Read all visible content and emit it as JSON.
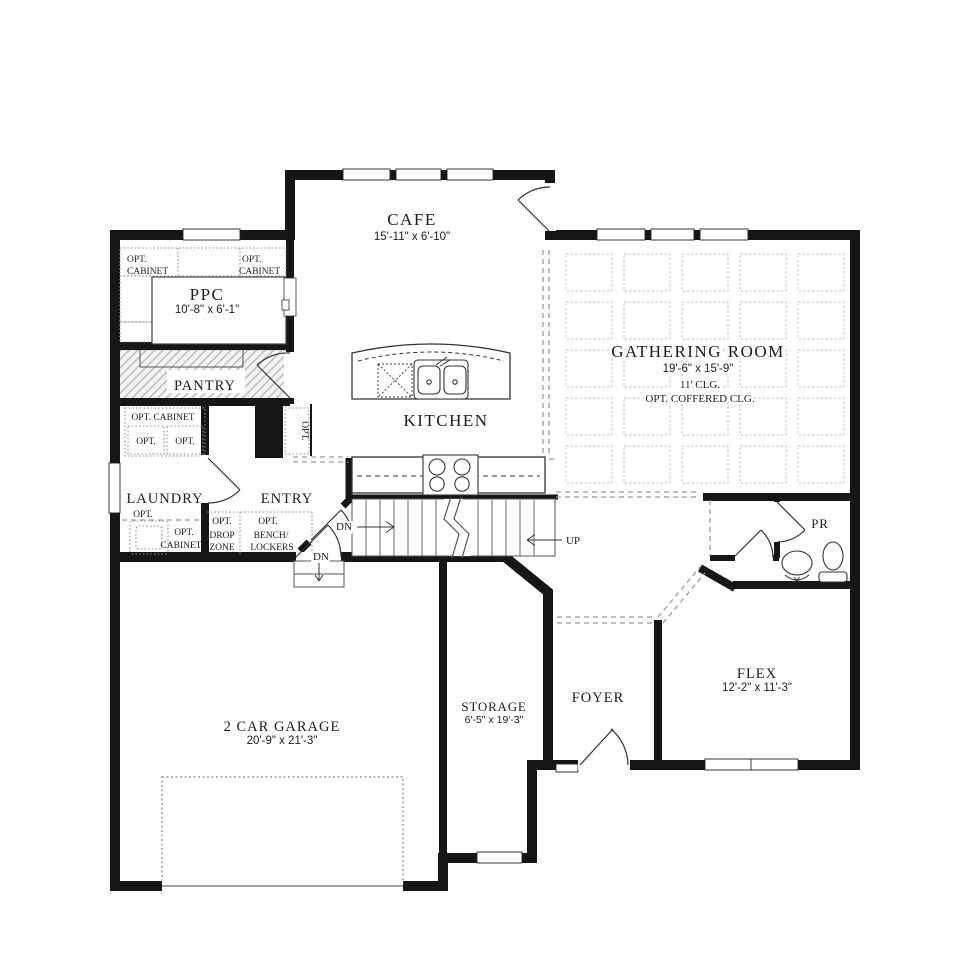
{
  "rooms": {
    "cafe": {
      "label": "CAFE",
      "dims": "15'-11\" x 6'-10\""
    },
    "ppc": {
      "label": "PPC",
      "dims": "10'-8\" x 6'-1\""
    },
    "pantry": {
      "label": "PANTRY"
    },
    "laundry": {
      "label": "LAUNDRY"
    },
    "entry": {
      "label": "ENTRY"
    },
    "kitchen": {
      "label": "KITCHEN"
    },
    "gathering_room": {
      "label": "GATHERING ROOM",
      "dims": "19'-6\" x 15'-9\"",
      "ceiling": "11' CLG.",
      "ceiling_option": "OPT. COFFERED CLG."
    },
    "powder_room": {
      "label": "PR"
    },
    "flex": {
      "label": "FLEX",
      "dims": "12'-2\" x 11'-3\""
    },
    "foyer": {
      "label": "FOYER"
    },
    "storage": {
      "label": "STORAGE",
      "dims": "6'-5\" x 19'-3\""
    },
    "garage": {
      "label": "2 CAR GARAGE",
      "dims": "20'-9\" x 21'-3\""
    }
  },
  "options": {
    "opt": "OPT.",
    "cabinet": "CABINET",
    "opt_cabinet_line": "OPT. CABINET",
    "drop_zone_l1": "OPT.",
    "drop_zone_l2": "DROP",
    "drop_zone_l3": "ZONE",
    "bench_l1": "OPT.",
    "bench_l2": "BENCH/",
    "bench_l3": "LOCKERS"
  },
  "stairs": {
    "up_label": "UP",
    "down_label": "DN"
  },
  "colors": {
    "wall": "#161616",
    "dashed_line": "#9b9b9b",
    "coffer_grid": "#bfbfbf",
    "background": "#ffffff"
  }
}
